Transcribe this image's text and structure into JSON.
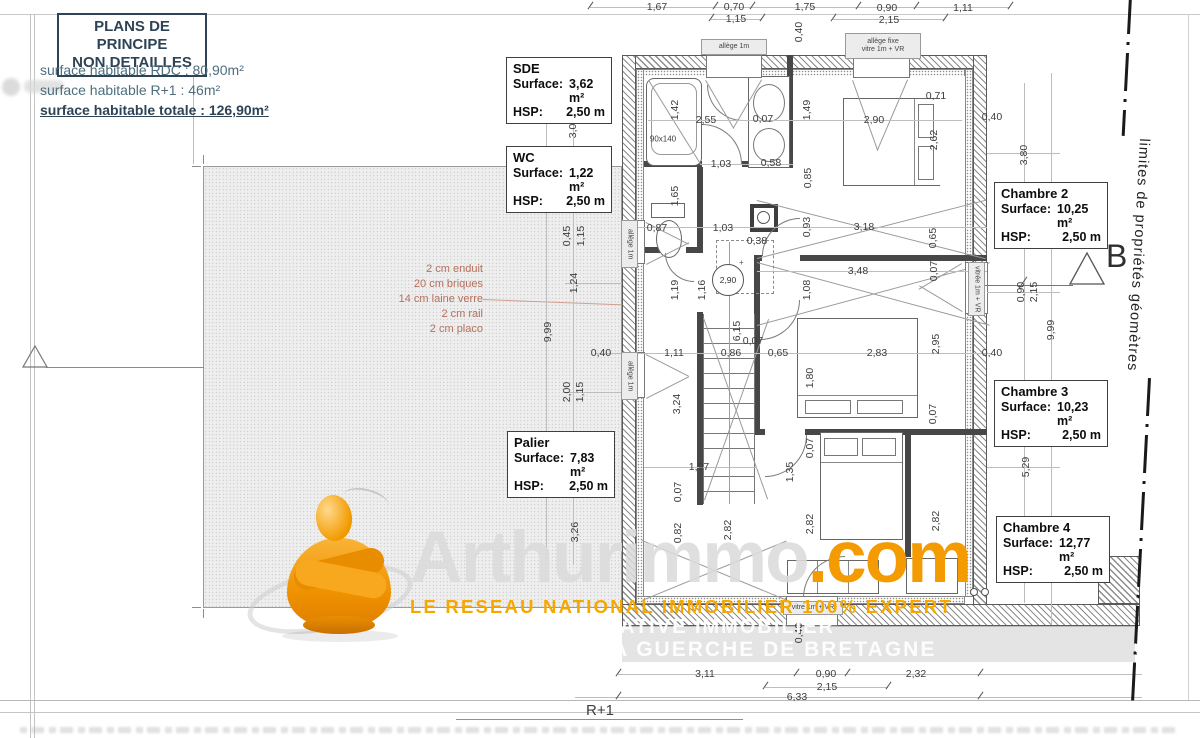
{
  "header": {
    "title_line1": "PLANS DE PRINCIPE",
    "title_line2": "NON DETAILLES",
    "surface_rdc": "surface habitable RDC : 80,90m²",
    "surface_r1": "surface habitable R+1 : 46m²",
    "surface_total": "surface habitable totale : 126,90m²"
  },
  "labels": {
    "surface_label": "Surface:",
    "hsp_label": "HSP:"
  },
  "rooms": [
    {
      "name": "SDE",
      "surface": "3,62 m²",
      "hsp": "2,50 m"
    },
    {
      "name": "WC",
      "surface": "1,22 m²",
      "hsp": "2,50 m"
    },
    {
      "name": "Palier",
      "surface": "7,83 m²",
      "hsp": "2,50 m"
    },
    {
      "name": "Chambre 2",
      "surface": "10,25 m²",
      "hsp": "2,50 m"
    },
    {
      "name": "Chambre 3",
      "surface": "10,23 m²",
      "hsp": "2,50 m"
    },
    {
      "name": "Chambre 4",
      "surface": "12,77 m²",
      "hsp": "2,50 m"
    }
  ],
  "wall_note": {
    "lines": [
      "2 cm enduit",
      "20 cm briques",
      "14 cm laine verre",
      "2 cm rail",
      "2 cm placo"
    ]
  },
  "markers": {
    "section_b": "B",
    "ceiling_circle": "2,90"
  },
  "boundary_text": "limites de propriétés géomètres",
  "floor_label": "R+1",
  "watermark": {
    "brand": "Arthurimmo",
    "tld": ".com",
    "tagline": "LE RESEAU NATIONAL IMMOBILIER 100% EXPERT",
    "strip_line1": "ATIVE IMMOBILIER",
    "strip_line2": "A GUERCHE DE BRETAGNE",
    "orange": "#f39b00"
  },
  "window_labels": [
    {
      "t": "allège 1m",
      "x": 701,
      "y": 39,
      "w": 64,
      "h": 14,
      "v": 0
    },
    {
      "t": "allège fixe",
      "t2": "vitre 1m + VR",
      "x": 845,
      "y": 33,
      "w": 74,
      "h": 24,
      "v": 0
    },
    {
      "t": "allège 1m",
      "x": 621,
      "y": 220,
      "w": 15,
      "h": 46,
      "v": 1
    },
    {
      "t": "allège 1m",
      "x": 621,
      "y": 352,
      "w": 15,
      "h": 46,
      "v": 1
    },
    {
      "t": "vitrée 1m + VR",
      "x": 968,
      "y": 262,
      "w": 15,
      "h": 52,
      "v": 1
    },
    {
      "t": "vitre 1m + VR",
      "x": 783,
      "y": 601,
      "w": 58,
      "h": 12,
      "v": 0
    }
  ],
  "dimensions": [
    {
      "t": "1,67",
      "x": 657,
      "y": 7
    },
    {
      "t": "0,70",
      "x": 734,
      "y": 7
    },
    {
      "t": "1,15",
      "x": 736,
      "y": 19
    },
    {
      "t": "1,75",
      "x": 805,
      "y": 7
    },
    {
      "t": "0,90",
      "x": 887,
      "y": 8
    },
    {
      "t": "2,15",
      "x": 889,
      "y": 20
    },
    {
      "t": "1,11",
      "x": 963,
      "y": 8
    },
    {
      "t": "0,40",
      "x": 799,
      "y": 32,
      "r": 1
    },
    {
      "t": "0,40",
      "x": 601,
      "y": 117
    },
    {
      "t": "0,40",
      "x": 992,
      "y": 117
    },
    {
      "t": "0,40",
      "x": 601,
      "y": 353
    },
    {
      "t": "0,40",
      "x": 992,
      "y": 353
    },
    {
      "t": "0,40",
      "x": 799,
      "y": 633,
      "r": 1
    },
    {
      "t": "3,04",
      "x": 573,
      "y": 128,
      "r": 1
    },
    {
      "t": "0,45",
      "x": 567,
      "y": 236,
      "r": 1
    },
    {
      "t": "1,15",
      "x": 581,
      "y": 236,
      "r": 1
    },
    {
      "t": "1,24",
      "x": 574,
      "y": 283,
      "r": 1
    },
    {
      "t": "9,99",
      "x": 548,
      "y": 332,
      "r": 1
    },
    {
      "t": "2,00",
      "x": 567,
      "y": 392,
      "r": 1
    },
    {
      "t": "1,15",
      "x": 580,
      "y": 392,
      "r": 1
    },
    {
      "t": "3,26",
      "x": 575,
      "y": 532,
      "r": 1
    },
    {
      "t": "3,80",
      "x": 1024,
      "y": 155,
      "r": 1
    },
    {
      "t": "0,90",
      "x": 1021,
      "y": 292,
      "r": 1
    },
    {
      "t": "2,15",
      "x": 1034,
      "y": 292,
      "r": 1
    },
    {
      "t": "9,99",
      "x": 1051,
      "y": 330,
      "r": 1
    },
    {
      "t": "5,29",
      "x": 1026,
      "y": 467,
      "r": 1
    },
    {
      "t": "1,42",
      "x": 675,
      "y": 110,
      "r": 1
    },
    {
      "t": "2,55",
      "x": 706,
      "y": 120
    },
    {
      "t": "0,07",
      "x": 763,
      "y": 119
    },
    {
      "t": "1,49",
      "x": 807,
      "y": 110,
      "r": 1
    },
    {
      "t": "2,90",
      "x": 874,
      "y": 120
    },
    {
      "t": "0,71",
      "x": 936,
      "y": 96
    },
    {
      "t": "2,62",
      "x": 934,
      "y": 140,
      "r": 1
    },
    {
      "t": "90x140",
      "x": 663,
      "y": 139,
      "s": 1
    },
    {
      "t": "1,03",
      "x": 721,
      "y": 164
    },
    {
      "t": "0,58",
      "x": 771,
      "y": 163
    },
    {
      "t": "0,85",
      "x": 808,
      "y": 178,
      "r": 1
    },
    {
      "t": "1,65",
      "x": 675,
      "y": 196,
      "r": 1
    },
    {
      "t": "0,87",
      "x": 657,
      "y": 228
    },
    {
      "t": "1,03",
      "x": 723,
      "y": 228
    },
    {
      "t": "0,38",
      "x": 757,
      "y": 241
    },
    {
      "t": "0,93",
      "x": 807,
      "y": 227,
      "r": 1
    },
    {
      "t": "3,18",
      "x": 864,
      "y": 227
    },
    {
      "t": "0,65",
      "x": 933,
      "y": 238,
      "r": 1
    },
    {
      "t": "3,48",
      "x": 858,
      "y": 271
    },
    {
      "t": "0,07",
      "x": 934,
      "y": 271,
      "r": 1
    },
    {
      "t": "1,08",
      "x": 807,
      "y": 290,
      "r": 1
    },
    {
      "t": "1,19",
      "x": 675,
      "y": 290,
      "r": 1
    },
    {
      "t": "1,16",
      "x": 702,
      "y": 290,
      "r": 1
    },
    {
      "t": "6,15",
      "x": 737,
      "y": 331,
      "r": 1
    },
    {
      "t": "0,07",
      "x": 753,
      "y": 341
    },
    {
      "t": "1,11",
      "x": 674,
      "y": 353
    },
    {
      "t": "0,86",
      "x": 731,
      "y": 353
    },
    {
      "t": "0,65",
      "x": 778,
      "y": 353
    },
    {
      "t": "2,83",
      "x": 877,
      "y": 353
    },
    {
      "t": "2,95",
      "x": 936,
      "y": 344,
      "r": 1
    },
    {
      "t": "1,80",
      "x": 810,
      "y": 378,
      "r": 1
    },
    {
      "t": "3,24",
      "x": 677,
      "y": 404,
      "r": 1
    },
    {
      "t": "0,07",
      "x": 933,
      "y": 414,
      "r": 1
    },
    {
      "t": "1,97",
      "x": 699,
      "y": 467
    },
    {
      "t": "0,07",
      "x": 678,
      "y": 492,
      "r": 1
    },
    {
      "t": "0,07",
      "x": 810,
      "y": 448,
      "r": 1
    },
    {
      "t": "1,35",
      "x": 790,
      "y": 472,
      "r": 1
    },
    {
      "t": "0,82",
      "x": 678,
      "y": 533,
      "r": 1
    },
    {
      "t": "2,82",
      "x": 810,
      "y": 524,
      "r": 1
    },
    {
      "t": "2,82",
      "x": 936,
      "y": 521,
      "r": 1
    },
    {
      "t": "2,82",
      "x": 728,
      "y": 530,
      "r": 1
    },
    {
      "t": "3,11",
      "x": 705,
      "y": 674
    },
    {
      "t": "0,90",
      "x": 826,
      "y": 674
    },
    {
      "t": "2,15",
      "x": 827,
      "y": 687
    },
    {
      "t": "2,32",
      "x": 916,
      "y": 674
    },
    {
      "t": "6,33",
      "x": 797,
      "y": 697
    }
  ]
}
